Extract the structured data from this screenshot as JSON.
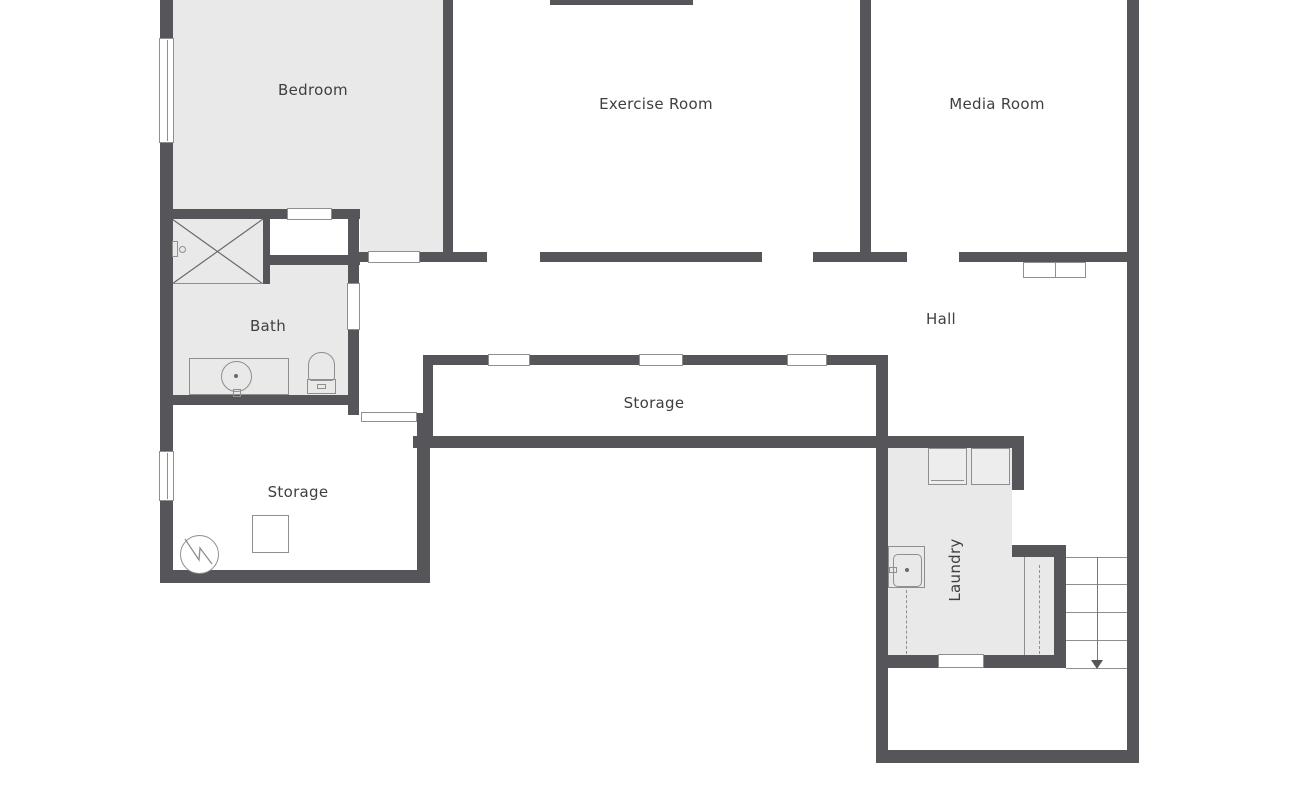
{
  "floorplan": {
    "labels": {
      "bedroom": "Bedroom",
      "exercise_room": "Exercise Room",
      "media_room": "Media Room",
      "bath": "Bath",
      "hall": "Hall",
      "storage_center": "Storage",
      "storage_lower": "Storage",
      "laundry": "Laundry"
    },
    "fixtures": [
      "shower",
      "shower-valve",
      "vanity-sink",
      "toilet",
      "closet-cabinets",
      "washer",
      "dryer",
      "utility-sink",
      "water-heater",
      "storage-box",
      "stairs-down-arrow",
      "windows",
      "doors"
    ],
    "colors": {
      "wall": "#56565a",
      "shaded_floor": "#e9e9e9",
      "floor": "#ffffff",
      "outline": "#8f8f8f",
      "label_text": "#3f3f3f"
    }
  }
}
